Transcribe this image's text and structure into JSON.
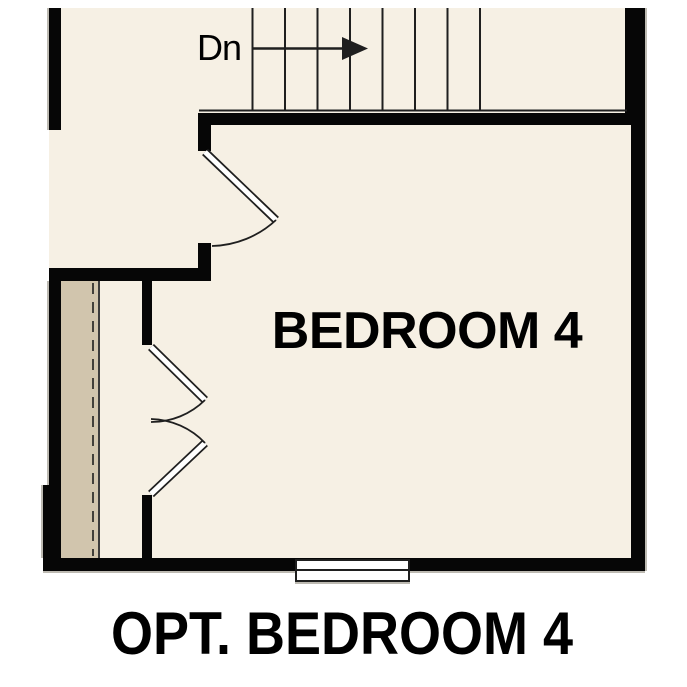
{
  "plan": {
    "stairs_label": "Dn",
    "room_label": "BEDROOM 4",
    "caption": "OPT. BEDROOM 4",
    "stair_tread_count": 8
  },
  "colors": {
    "background": "#ffffff",
    "floor": "#f6f0e4",
    "closet_floor": "#d1c5ad",
    "wall": "#060606",
    "line": "#1f1f1f",
    "symbol_fill": "#ffffff",
    "text": "#000000",
    "outer_edge": "#bdbab2"
  }
}
